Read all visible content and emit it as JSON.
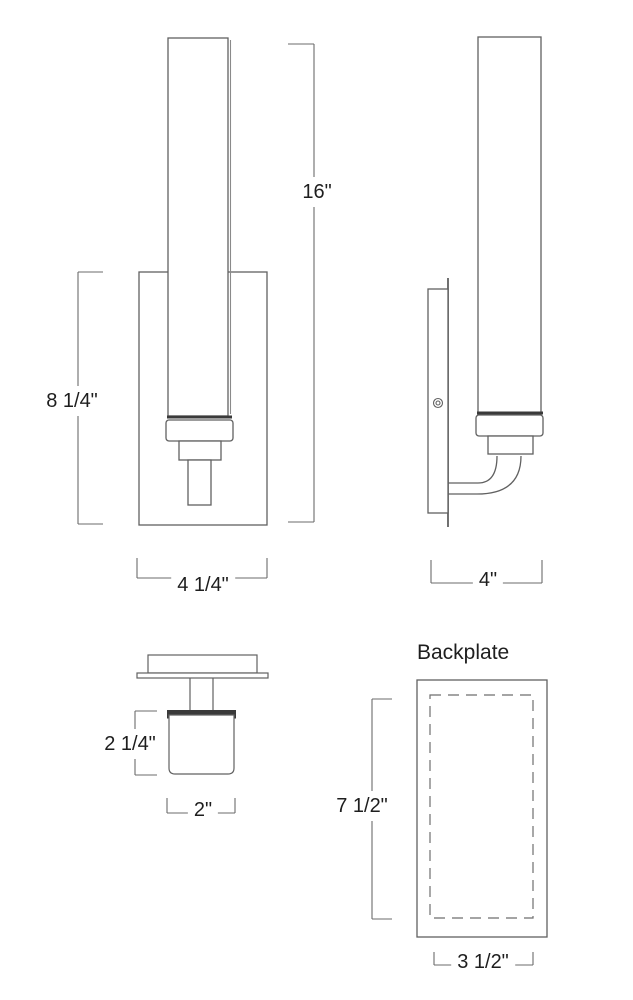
{
  "figure": {
    "front_view": {
      "dims": {
        "glass_height": "16\"",
        "backplate_height": "8 1/4\"",
        "backplate_width": "4 1/4\""
      }
    },
    "side_view": {
      "dims": {
        "depth": "4\""
      }
    },
    "top_view": {
      "dims": {
        "glass_depth": "2 1/4\"",
        "glass_width": "2\""
      }
    },
    "backplate_view": {
      "label": "Backplate",
      "dims": {
        "height": "7 1/2\"",
        "width": "3 1/2\""
      }
    }
  },
  "colors": {
    "background": "#ffffff",
    "line": "#616161",
    "dark_line": "#3a3a3a",
    "text": "#1e1e1e"
  }
}
